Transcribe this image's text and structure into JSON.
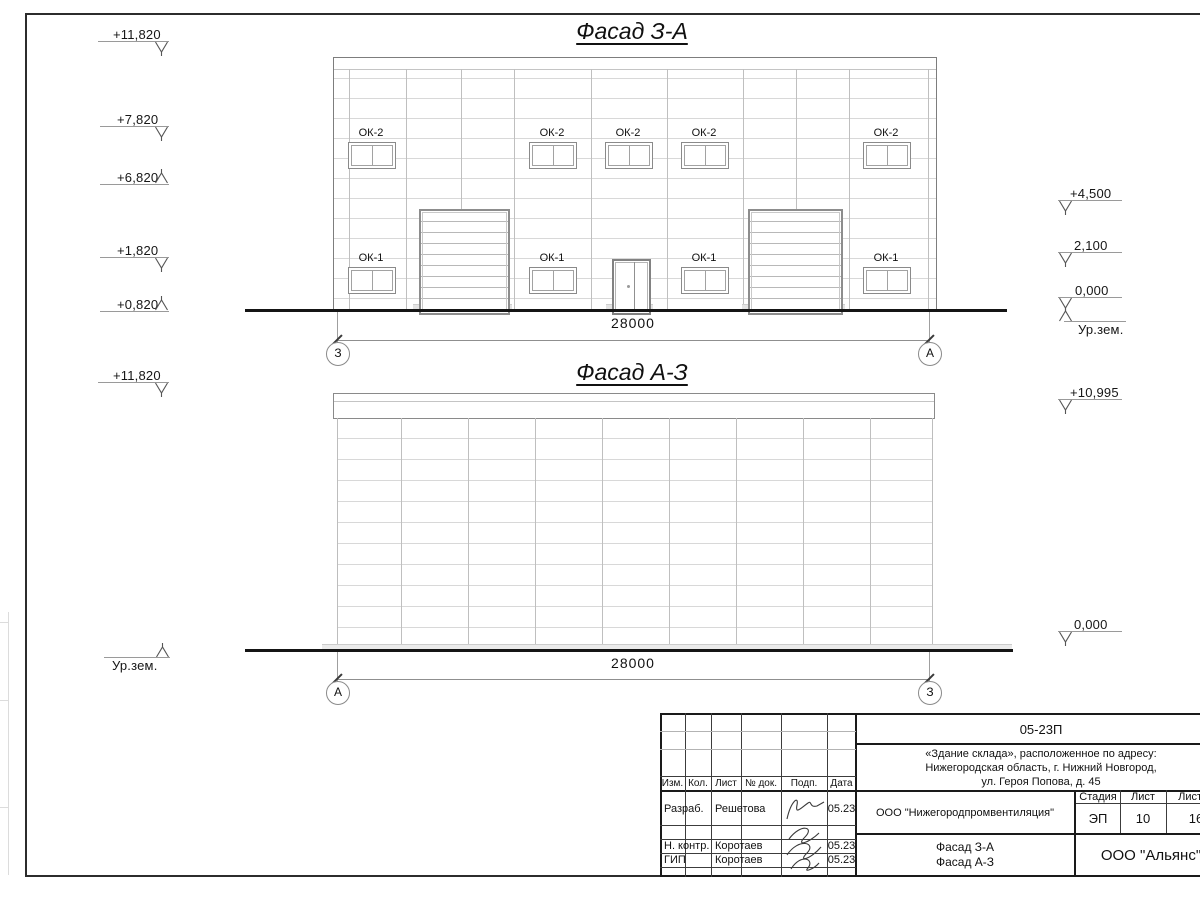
{
  "facade1": {
    "title": "Фасад З-А",
    "dim": "28000",
    "axis_left": "З",
    "axis_right": "А",
    "upper_windows": [
      "ОК-2",
      "ОК-2",
      "ОК-2",
      "ОК-2",
      "ОК-2"
    ],
    "lower_windows": [
      "ОК-1",
      "ОК-1",
      "ОК-1",
      "ОК-1"
    ],
    "marks_left": [
      "+11,820",
      "+7,820",
      "+6,820",
      "+1,820",
      "+0,820"
    ],
    "marks_right": [
      "+4,500",
      "2,100",
      "0,000",
      "Ур.зем."
    ]
  },
  "facade2": {
    "title": "Фасад А-З",
    "dim": "28000",
    "axis_left": "А",
    "axis_right": "З",
    "marks_left": [
      "+11,820",
      "Ур.зем."
    ],
    "marks_right": [
      "+10,995",
      "0,000"
    ]
  },
  "titleblock": {
    "code": "05-23П",
    "project_line1": "«Здание склада», расположенное по адресу:",
    "project_line2": "Нижегородская область, г. Нижний Новгород,",
    "project_line3": "ул. Героя Попова, д. 45",
    "col_izm": "Изм.",
    "col_kol": "Кол.",
    "col_list": "Лист",
    "col_doc": "№ док.",
    "col_podp": "Подп.",
    "col_data": "Дата",
    "row1_role": "Разраб.",
    "row1_name": "Решетова",
    "row1_date": "05.23",
    "row2_role": "Н. контр.",
    "row2_name": "Коротаев",
    "row2_date": "05.23",
    "row3_role": "ГИП",
    "row3_name": "Коротаев",
    "row3_date": "05.23",
    "org": "ООО \"Нижегородпромвентиляция\"",
    "stage_label": "Стадия",
    "list_label": "Лист",
    "listov_label": "Листов",
    "stage": "ЭП",
    "list_no": "10",
    "listov_no": "16",
    "title_line1": "Фасад З-А",
    "title_line2": "Фасад А-З",
    "company": "ООО \"Альянс\""
  }
}
